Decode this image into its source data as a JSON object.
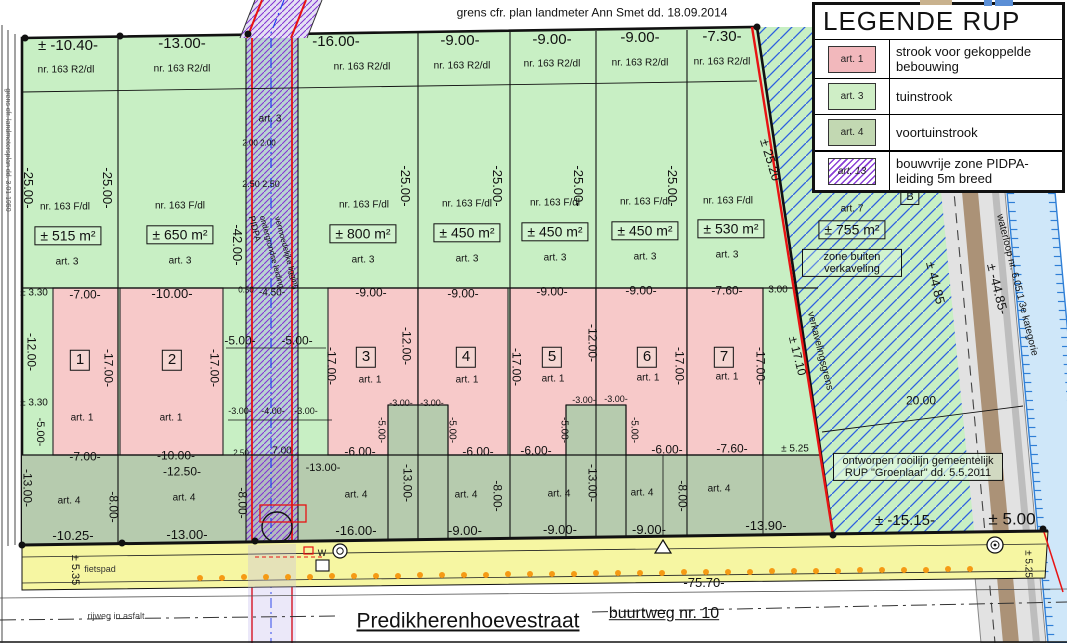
{
  "title_note": "grens cfr. plan landmeter Ann Smet dd. 18.09.2014",
  "legend": {
    "title": "LEGENDE RUP",
    "items": [
      {
        "code": "art. 1",
        "swatch": "pink",
        "label": "strook voor gekoppelde bebouwing"
      },
      {
        "code": "art. 3",
        "swatch": "light-green",
        "label": "tuinstrook"
      },
      {
        "code": "art. 4",
        "swatch": "green",
        "label": "voortuinstrook"
      },
      {
        "code": "art. 13",
        "swatch": "purple-hatch",
        "label": "bouwvrije zone PIDPA-leiding 5m breed"
      }
    ]
  },
  "street": {
    "name": "Predikherenhoevestraat",
    "road_ref": "buurtweg nr. 10",
    "cycle_path": "fietspad",
    "surface": "rijweg in asfalt",
    "total_length": "-75.70-"
  },
  "lots": [
    {
      "number": "1",
      "street_width": "± -10.40-",
      "parcel_front": "nr. 163 R2/dl",
      "parcel": "nr. 163 F/dl",
      "area": "± 515 m²",
      "depth": "-25.00-",
      "garden_zone": "art. 3",
      "build_zone": "art. 1",
      "build_width": "-7.00-",
      "build_depth": "-17.00-",
      "front_zone": "art. 4"
    },
    {
      "number": "2",
      "street_width": "-13.00-",
      "parcel_front": "nr. 163 R2/dl",
      "parcel": "nr. 163 F/dl",
      "area": "± 650 m²",
      "depth": "-25.00-",
      "garden_zone": "art. 3",
      "build_zone": "art. 1",
      "build_width": "-10.00-",
      "build_depth": "-17.00-",
      "front_zone": "art. 4"
    },
    {
      "number": "3",
      "street_width": "-16.00-",
      "parcel_front": "nr. 163 R2/dl",
      "parcel": "nr. 163 F/dl",
      "area": "± 800 m²",
      "depth": "-25.00-",
      "garden_zone": "art. 3",
      "build_zone": "art. 1",
      "build_width": "-9.00-",
      "build_depth": "-17.00-",
      "front_zone": "art. 4"
    },
    {
      "number": "4",
      "street_width": "-9.00-",
      "parcel_front": "nr. 163 R2/dl",
      "parcel": "nr. 163 F/dl",
      "area": "± 450 m²",
      "depth": "-25.00-",
      "garden_zone": "art. 3",
      "build_zone": "art. 1",
      "build_width": "-9.00-",
      "build_depth": "-17.00-",
      "front_zone": "art. 4"
    },
    {
      "number": "5",
      "street_width": "-9.00-",
      "parcel_front": "nr. 163 R2/dl",
      "parcel": "nr. 163 F/dl",
      "area": "± 450 m²",
      "depth": "-25.00-",
      "garden_zone": "art. 3",
      "build_zone": "art. 1",
      "build_width": "-9.00-",
      "build_depth": "-17.00-",
      "front_zone": "art. 4"
    },
    {
      "number": "6",
      "street_width": "-9.00-",
      "parcel_front": "nr. 163 R2/dl",
      "parcel": "nr. 163 F/dl",
      "area": "± 450 m²",
      "depth": "-25.00-",
      "garden_zone": "art. 3",
      "build_zone": "art. 1",
      "build_width": "-9.00-",
      "build_depth": "-17.00-",
      "front_zone": "art. 4"
    },
    {
      "number": "7",
      "street_width": "-7.30-",
      "parcel_front": "nr. 163 R2/dl",
      "parcel": "nr. 163 F/dl",
      "area": "± 530 m²",
      "depth": "± 25.20",
      "garden_zone": "art. 3",
      "build_zone": "art. 1",
      "build_width": "-7.60-",
      "build_depth": "-17.00-",
      "front_zone": "art. 4"
    }
  ],
  "colors": {
    "tuinstrook": "#c8efc4",
    "voortuinstrook": "#b6cbae",
    "bebouwing": "#f7c9c9",
    "pidpa_strip": "#b7e2cc",
    "street_yellow": "#f6f6a2",
    "boundary_red": "#e81313",
    "pidpa_purple": "#8233d2",
    "outside_hatch_blue": "#2d5fe0",
    "waterloop_blue": "#cfe7f9",
    "road_brown": "#ab9277"
  },
  "labels": [
    {
      "t": "grens cfr. plan landmeter Ann Smet dd. 18.09.2014",
      "x": 592,
      "y": 13,
      "s": 12
    },
    {
      "t": "± -10.40-",
      "x": 68,
      "y": 46,
      "s": 15
    },
    {
      "t": "-13.00-",
      "x": 182,
      "y": 44,
      "s": 15
    },
    {
      "t": "-16.00-",
      "x": 336,
      "y": 42,
      "s": 15
    },
    {
      "t": "-9.00-",
      "x": 460,
      "y": 41,
      "s": 15
    },
    {
      "t": "-9.00-",
      "x": 552,
      "y": 40,
      "s": 15
    },
    {
      "t": "-9.00-",
      "x": 640,
      "y": 38,
      "s": 15
    },
    {
      "t": "-7.30-",
      "x": 722,
      "y": 37,
      "s": 15
    },
    {
      "t": "nr. 163 R2/dl",
      "x": 66,
      "y": 70,
      "s": 10
    },
    {
      "t": "nr. 163 R2/dl",
      "x": 182,
      "y": 69,
      "s": 10
    },
    {
      "t": "nr. 163 R2/dl",
      "x": 362,
      "y": 67,
      "s": 10
    },
    {
      "t": "nr. 163 R2/dl",
      "x": 462,
      "y": 66,
      "s": 10
    },
    {
      "t": "nr. 163 R2/dl",
      "x": 552,
      "y": 64,
      "s": 10
    },
    {
      "t": "nr. 163 R2/dl",
      "x": 640,
      "y": 63,
      "s": 10
    },
    {
      "t": "nr. 163 R2/dl",
      "x": 722,
      "y": 62,
      "s": 10
    },
    {
      "t": "-25.00-",
      "x": 28,
      "y": 188,
      "r": 90,
      "s": 13
    },
    {
      "t": "-25.00-",
      "x": 107,
      "y": 188,
      "r": 90,
      "s": 13
    },
    {
      "t": "-25.00-",
      "x": 405,
      "y": 186,
      "r": 90,
      "s": 13
    },
    {
      "t": "-25.00-",
      "x": 497,
      "y": 186,
      "r": 90,
      "s": 13
    },
    {
      "t": "-25.00-",
      "x": 578,
      "y": 186,
      "r": 90,
      "s": 13
    },
    {
      "t": "-25.00-",
      "x": 672,
      "y": 186,
      "r": 90,
      "s": 13
    },
    {
      "t": "± 25.20",
      "x": 770,
      "y": 160,
      "r": 73,
      "s": 13
    },
    {
      "t": "nr. 163 F/dl",
      "x": 65,
      "y": 207,
      "s": 10
    },
    {
      "t": "nr. 163 F/dl",
      "x": 180,
      "y": 206,
      "s": 10
    },
    {
      "t": "nr. 163 F/dl",
      "x": 364,
      "y": 205,
      "s": 10
    },
    {
      "t": "nr. 163 F/dl",
      "x": 467,
      "y": 204,
      "s": 10
    },
    {
      "t": "nr. 163 F/dl",
      "x": 555,
      "y": 203,
      "s": 10
    },
    {
      "t": "nr. 163 F/dl",
      "x": 645,
      "y": 202,
      "s": 10
    },
    {
      "t": "nr. 163 F/dl",
      "x": 728,
      "y": 201,
      "s": 10
    },
    {
      "t": "nr. 163 F/dl",
      "x": 868,
      "y": 190,
      "s": 10
    },
    {
      "t": "± 515 m²",
      "x": 68,
      "y": 236,
      "s": 14,
      "f": "box"
    },
    {
      "t": "± 650 m²",
      "x": 180,
      "y": 235,
      "s": 14,
      "f": "box"
    },
    {
      "t": "± 800 m²",
      "x": 363,
      "y": 234,
      "s": 14,
      "f": "box"
    },
    {
      "t": "± 450 m²",
      "x": 467,
      "y": 233,
      "s": 14,
      "f": "box"
    },
    {
      "t": "± 450 m²",
      "x": 555,
      "y": 232,
      "s": 14,
      "f": "box"
    },
    {
      "t": "± 450 m²",
      "x": 645,
      "y": 231,
      "s": 14,
      "f": "box"
    },
    {
      "t": "± 530 m²",
      "x": 731,
      "y": 229,
      "s": 14,
      "f": "box"
    },
    {
      "t": "± 755 m²",
      "x": 852,
      "y": 230,
      "s": 14,
      "f": "box"
    },
    {
      "t": "art. 3",
      "x": 67,
      "y": 262,
      "s": 10
    },
    {
      "t": "art. 3",
      "x": 180,
      "y": 261,
      "s": 10
    },
    {
      "t": "art. 3",
      "x": 363,
      "y": 260,
      "s": 10
    },
    {
      "t": "art. 3",
      "x": 467,
      "y": 259,
      "s": 10
    },
    {
      "t": "art. 3",
      "x": 555,
      "y": 258,
      "s": 10
    },
    {
      "t": "art. 3",
      "x": 645,
      "y": 257,
      "s": 10
    },
    {
      "t": "art. 3",
      "x": 727,
      "y": 255,
      "s": 10
    },
    {
      "t": "art. 3",
      "x": 270,
      "y": 119,
      "s": 10
    },
    {
      "t": "art. 7",
      "x": 852,
      "y": 209,
      "s": 10
    },
    {
      "t": "B",
      "x": 910,
      "y": 197,
      "s": 11,
      "f": "box"
    },
    {
      "t": "zone buiten verkaveling",
      "x": 852,
      "y": 263,
      "s": 11,
      "f": "box",
      "w": 88
    },
    {
      "t": "2.00 2.00",
      "x": 259,
      "y": 144,
      "s": 8
    },
    {
      "t": "2.50 2.50",
      "x": 261,
      "y": 185,
      "s": 9
    },
    {
      "t": "-42.00-",
      "x": 237,
      "y": 245,
      "r": 90,
      "s": 13
    },
    {
      "t": "PIDPA",
      "x": 254,
      "y": 229,
      "r": 75,
      "s": 9
    },
    {
      "t": "ondergrondse leiding",
      "x": 271,
      "y": 252,
      "r": 75,
      "s": 8
    },
    {
      "t": "vermoedelijke ligging",
      "x": 286,
      "y": 253,
      "r": 75,
      "s": 8
    },
    {
      "t": "0.50",
      "x": 246,
      "y": 291,
      "s": 8
    },
    {
      "t": "-4.50-",
      "x": 272,
      "y": 293,
      "s": 10
    },
    {
      "t": "-5.00-",
      "x": 240,
      "y": 341,
      "s": 12
    },
    {
      "t": "-5.00-",
      "x": 297,
      "y": 341,
      "s": 12
    },
    {
      "t": "-3.00-",
      "x": 240,
      "y": 412,
      "s": 9
    },
    {
      "t": "-4.00-",
      "x": 273,
      "y": 412,
      "s": 9
    },
    {
      "t": "-3.00-",
      "x": 306,
      "y": 412,
      "s": 9
    },
    {
      "t": "2.50",
      "x": 241,
      "y": 454,
      "s": 8
    },
    {
      "t": "7.00",
      "x": 282,
      "y": 451,
      "s": 10
    },
    {
      "t": "-13.00-",
      "x": 323,
      "y": 468,
      "s": 11
    },
    {
      "t": "± 3.30",
      "x": 34,
      "y": 293,
      "s": 10
    },
    {
      "t": "-12.00-",
      "x": 31,
      "y": 352,
      "r": 90,
      "s": 12
    },
    {
      "t": "± 3.30",
      "x": 34,
      "y": 403,
      "s": 10
    },
    {
      "t": "-5.00-",
      "x": 40,
      "y": 432,
      "r": 90,
      "s": 11
    },
    {
      "t": "-13.00-",
      "x": 27,
      "y": 488,
      "r": 90,
      "s": 12
    },
    {
      "t": "grens cfr. landmetersplan dd. 3.01.1950",
      "x": 7,
      "y": 150,
      "r": 90,
      "s": 7,
      "c": "#555"
    },
    {
      "t": "-7.00-",
      "x": 85,
      "y": 295,
      "s": 12
    },
    {
      "t": "1",
      "x": 80,
      "y": 360,
      "s": 15,
      "f": "box"
    },
    {
      "t": "-17.00-",
      "x": 108,
      "y": 368,
      "r": 90,
      "s": 12
    },
    {
      "t": "art. 1",
      "x": 82,
      "y": 418,
      "s": 10
    },
    {
      "t": "-7.00-",
      "x": 85,
      "y": 457,
      "s": 12
    },
    {
      "t": "-10.00-",
      "x": 172,
      "y": 294,
      "s": 13
    },
    {
      "t": "2",
      "x": 172,
      "y": 360,
      "s": 15,
      "f": "box"
    },
    {
      "t": "-17.00-",
      "x": 214,
      "y": 368,
      "r": 90,
      "s": 12
    },
    {
      "t": "art. 1",
      "x": 171,
      "y": 418,
      "s": 10
    },
    {
      "t": "-10.00-",
      "x": 176,
      "y": 456,
      "s": 12
    },
    {
      "t": "-12.50-",
      "x": 182,
      "y": 472,
      "s": 12
    },
    {
      "t": "-9.00-",
      "x": 371,
      "y": 293,
      "s": 12
    },
    {
      "t": "3",
      "x": 366,
      "y": 357,
      "s": 15,
      "f": "box"
    },
    {
      "t": "-17.00-",
      "x": 331,
      "y": 366,
      "r": 90,
      "s": 12
    },
    {
      "t": "-12.00-",
      "x": 406,
      "y": 346,
      "r": 90,
      "s": 12
    },
    {
      "t": "art. 1",
      "x": 370,
      "y": 380,
      "s": 10
    },
    {
      "t": "-3.00-",
      "x": 401,
      "y": 404,
      "s": 9
    },
    {
      "t": "-3.00-",
      "x": 432,
      "y": 404,
      "s": 9
    },
    {
      "t": "-5.00-",
      "x": 381,
      "y": 430,
      "r": 90,
      "s": 10
    },
    {
      "t": "-5.00-",
      "x": 452,
      "y": 430,
      "r": 90,
      "s": 10
    },
    {
      "t": "-6.00-",
      "x": 360,
      "y": 452,
      "s": 12
    },
    {
      "t": "-9.00-",
      "x": 463,
      "y": 294,
      "s": 12
    },
    {
      "t": "4",
      "x": 466,
      "y": 357,
      "s": 15,
      "f": "box"
    },
    {
      "t": "art. 1",
      "x": 467,
      "y": 380,
      "s": 10
    },
    {
      "t": "-17.00-",
      "x": 516,
      "y": 367,
      "r": 90,
      "s": 12
    },
    {
      "t": "-6.00-",
      "x": 478,
      "y": 452,
      "s": 12
    },
    {
      "t": "-9.00-",
      "x": 552,
      "y": 292,
      "s": 12
    },
    {
      "t": "5",
      "x": 552,
      "y": 357,
      "s": 15,
      "f": "box"
    },
    {
      "t": "art. 1",
      "x": 553,
      "y": 379,
      "s": 10
    },
    {
      "t": "-12.00-",
      "x": 592,
      "y": 343,
      "r": 90,
      "s": 12
    },
    {
      "t": "-3.00-",
      "x": 584,
      "y": 401,
      "s": 9
    },
    {
      "t": "-3.00-",
      "x": 616,
      "y": 400,
      "s": 9
    },
    {
      "t": "-5.00-",
      "x": 564,
      "y": 430,
      "r": 90,
      "s": 10
    },
    {
      "t": "-5.00-",
      "x": 634,
      "y": 430,
      "r": 90,
      "s": 10
    },
    {
      "t": "-6.00-",
      "x": 536,
      "y": 451,
      "s": 12
    },
    {
      "t": "-9.00-",
      "x": 641,
      "y": 291,
      "s": 12
    },
    {
      "t": "6",
      "x": 647,
      "y": 357,
      "s": 15,
      "f": "box"
    },
    {
      "t": "art. 1",
      "x": 648,
      "y": 378,
      "s": 10
    },
    {
      "t": "-17.00-",
      "x": 679,
      "y": 366,
      "r": 90,
      "s": 12
    },
    {
      "t": "-6.00-",
      "x": 667,
      "y": 450,
      "s": 12
    },
    {
      "t": "-7.60-",
      "x": 727,
      "y": 291,
      "s": 12
    },
    {
      "t": "7",
      "x": 724,
      "y": 357,
      "s": 15,
      "f": "box"
    },
    {
      "t": "art. 1",
      "x": 727,
      "y": 377,
      "s": 10
    },
    {
      "t": "-17.00-",
      "x": 760,
      "y": 366,
      "r": 90,
      "s": 12
    },
    {
      "t": "-7.60-",
      "x": 732,
      "y": 449,
      "s": 12
    },
    {
      "t": "3.00",
      "x": 778,
      "y": 290,
      "s": 10
    },
    {
      "t": "± 5.25",
      "x": 795,
      "y": 449,
      "s": 10
    },
    {
      "t": "art. 4",
      "x": 69,
      "y": 501,
      "s": 10
    },
    {
      "t": "-8.00-",
      "x": 113,
      "y": 507,
      "r": 90,
      "s": 12
    },
    {
      "t": "art. 4",
      "x": 184,
      "y": 498,
      "s": 10
    },
    {
      "t": "-8.00-",
      "x": 242,
      "y": 503,
      "r": 90,
      "s": 12
    },
    {
      "t": "art. 4",
      "x": 356,
      "y": 495,
      "s": 10
    },
    {
      "t": "-13.00-",
      "x": 407,
      "y": 483,
      "r": 90,
      "s": 12
    },
    {
      "t": "art. 4",
      "x": 466,
      "y": 495,
      "s": 10
    },
    {
      "t": "-8.00-",
      "x": 497,
      "y": 496,
      "r": 90,
      "s": 12
    },
    {
      "t": "art. 4",
      "x": 559,
      "y": 494,
      "s": 10
    },
    {
      "t": "-13.00-",
      "x": 592,
      "y": 483,
      "r": 90,
      "s": 12
    },
    {
      "t": "art. 4",
      "x": 642,
      "y": 493,
      "s": 10
    },
    {
      "t": "-8.00-",
      "x": 682,
      "y": 496,
      "r": 90,
      "s": 12
    },
    {
      "t": "art. 4",
      "x": 719,
      "y": 489,
      "s": 10
    },
    {
      "t": "-10.25-",
      "x": 73,
      "y": 536,
      "s": 13
    },
    {
      "t": "-13.00-",
      "x": 187,
      "y": 535,
      "s": 13
    },
    {
      "t": "-16.00-",
      "x": 356,
      "y": 531,
      "s": 13
    },
    {
      "t": "-9.00-",
      "x": 465,
      "y": 531,
      "s": 13
    },
    {
      "t": "-9.00-",
      "x": 560,
      "y": 530,
      "s": 13
    },
    {
      "t": "-9.00-",
      "x": 649,
      "y": 530,
      "s": 13
    },
    {
      "t": "-13.90-",
      "x": 766,
      "y": 526,
      "s": 13
    },
    {
      "t": "± -15.15-",
      "x": 905,
      "y": 521,
      "s": 15
    },
    {
      "t": "± 5.00",
      "x": 1012,
      "y": 520,
      "s": 17
    },
    {
      "t": "verkavelingsgrens",
      "x": 820,
      "y": 351,
      "r": 76,
      "s": 10
    },
    {
      "t": "± 17.10",
      "x": 797,
      "y": 356,
      "r": 76,
      "s": 12
    },
    {
      "t": "± 44.85",
      "x": 935,
      "y": 283,
      "r": 76,
      "s": 13
    },
    {
      "t": "± -44.85-",
      "x": 997,
      "y": 289,
      "r": 76,
      "s": 13
    },
    {
      "t": "waterloop nr. 6.05.1  3e kategorie",
      "x": 1017,
      "y": 285,
      "r": 76,
      "s": 10
    },
    {
      "t": "20.00",
      "x": 921,
      "y": 401,
      "s": 12
    },
    {
      "t": "ontworpen rooilijn gemeentelijk RUP \"Groenlaar\" dd. 5.5.2011",
      "x": 918,
      "y": 467,
      "s": 11,
      "f": "box bg",
      "w": 158
    },
    {
      "t": "± 5.35",
      "x": 75,
      "y": 570,
      "r": 90,
      "s": 11
    },
    {
      "t": "fietspad",
      "x": 100,
      "y": 570,
      "s": 9,
      "c": "#333"
    },
    {
      "t": "-75.70-",
      "x": 704,
      "y": 583,
      "s": 13
    },
    {
      "t": "rijweg in asfalt",
      "x": 116,
      "y": 617,
      "s": 9,
      "c": "#444"
    },
    {
      "t": "± 5.25",
      "x": 1028,
      "y": 564,
      "r": 90,
      "s": 10
    },
    {
      "t": "W",
      "x": 322,
      "y": 554,
      "s": 9
    },
    {
      "t": "Predikherenhoevestraat",
      "x": 468,
      "y": 621,
      "s": 21,
      "f": "u"
    },
    {
      "t": "buurtweg nr. 10",
      "x": 664,
      "y": 614,
      "s": 16,
      "f": "u"
    }
  ]
}
